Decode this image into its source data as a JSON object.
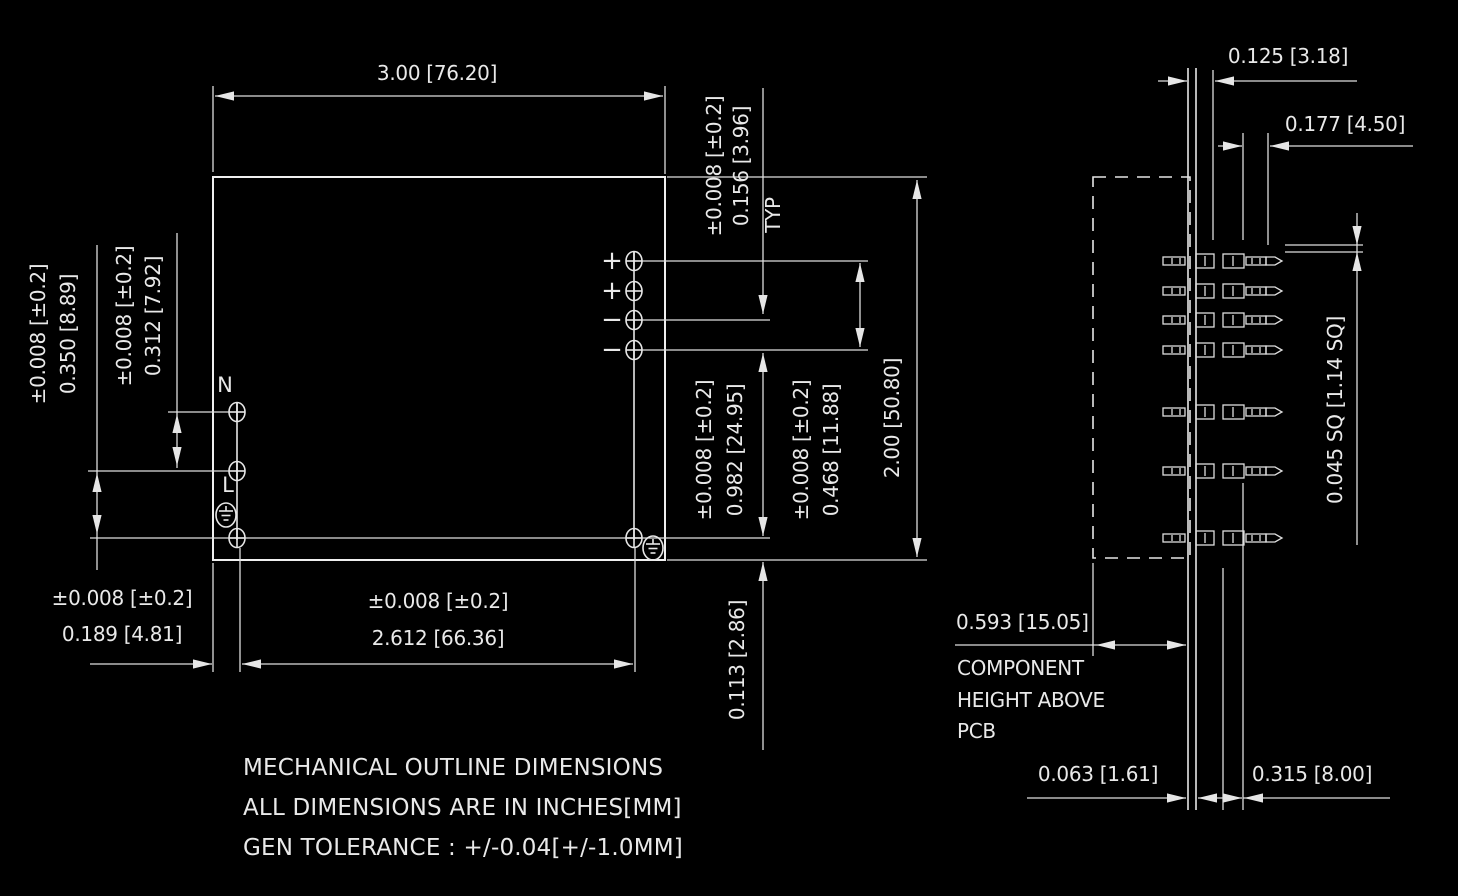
{
  "title": "mechanical-outline-drawing",
  "colors": {
    "background": "#000000",
    "line": "#e6e6e6"
  },
  "front_view": {
    "dim_width_top": "3.00 [76.20]",
    "dim_height_right": "2.00 [50.80]",
    "tol_156": "±0.008 [±0.2]",
    "dim_156": "0.156 [3.96]",
    "typ": "TYP",
    "tol_982": "±0.008 [±0.2]",
    "dim_982": "0.982 [24.95]",
    "tol_468": "±0.008 [±0.2]",
    "dim_468": "0.468 [11.88]",
    "tol_350": "±0.008 [±0.2]",
    "dim_350": "0.350 [8.89]",
    "tol_312": "±0.008 [±0.2]",
    "dim_312": "0.312 [7.92]",
    "tol_189": "±0.008 [±0.2]",
    "dim_189": "0.189 [4.81]",
    "tol_2612": "±0.008 [±0.2]",
    "dim_2612": "2.612 [66.36]",
    "dim_113": "0.113 [2.86]",
    "pin_labels": [
      "+",
      "+",
      "−",
      "−"
    ],
    "label_n": "N",
    "label_l": "L"
  },
  "side_view": {
    "dim_125": "0.125 [3.18]",
    "dim_177": "0.177 [4.50]",
    "dim_045": "0.045 SQ [1.14 SQ]",
    "dim_593": "0.593 [15.05]",
    "component_height_note": [
      "COMPONENT",
      "HEIGHT ABOVE",
      "PCB"
    ],
    "dim_063": "0.063 [1.61]",
    "dim_315": "0.315 [8.00]"
  },
  "notes": [
    "MECHANICAL OUTLINE DIMENSIONS",
    "ALL DIMENSIONS ARE IN INCHES[MM]",
    "GEN TOLERANCE : +/-0.04[+/-1.0MM]"
  ]
}
